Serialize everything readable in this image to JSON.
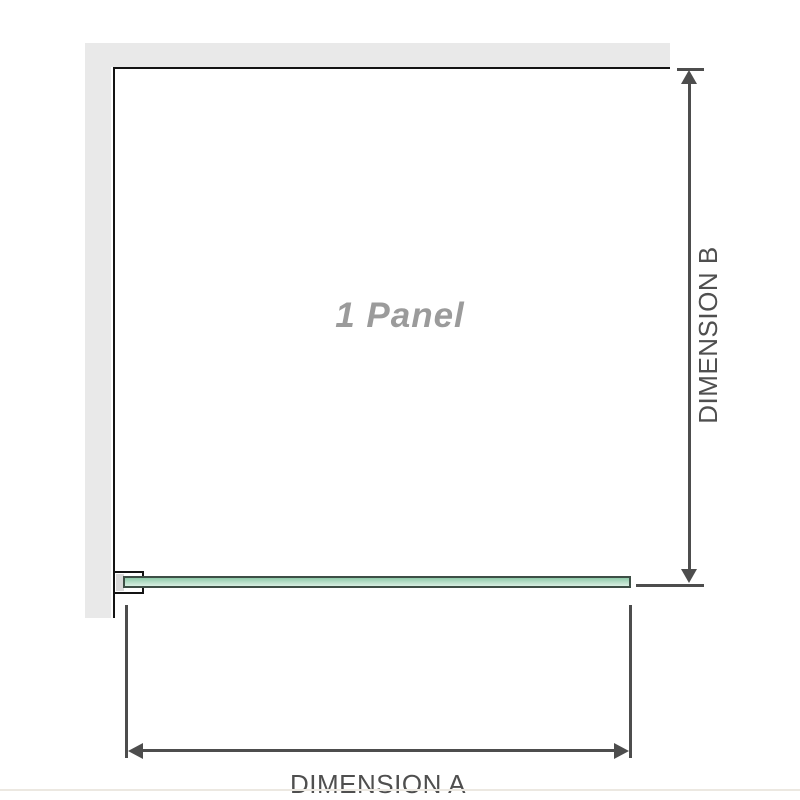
{
  "diagram": {
    "panel_label": "1 Panel",
    "dimensions": {
      "a_label": "DIMENSION A",
      "b_label": "DIMENSION B"
    }
  },
  "colors": {
    "wall_fill": "#e9e9e9",
    "outline": "#141414",
    "dimension_line": "#4d4d4d",
    "label_text": "#4f4f4f",
    "panel_label_text": "#9b9b9b",
    "glass_border": "#3d4e45",
    "glass_fill_top": "#8fcbaa",
    "glass_fill_bottom": "#d9efe3",
    "bracket_inset": "#d9d9d9",
    "bottom_edge": "#ece8e1"
  }
}
